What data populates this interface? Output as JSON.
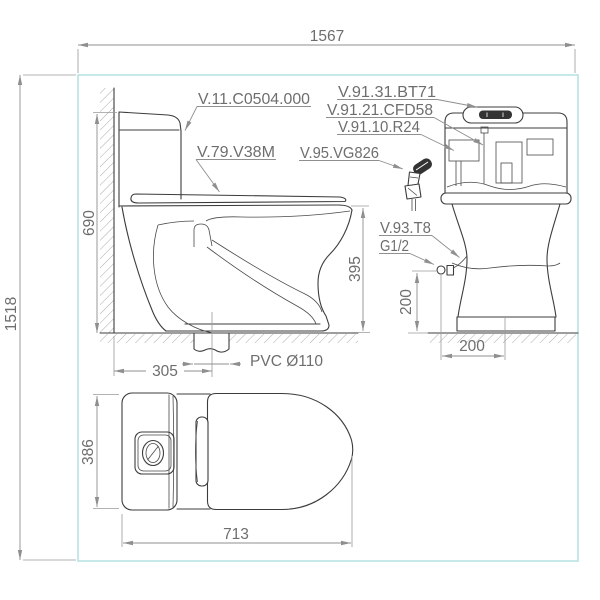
{
  "drawing": {
    "overall": {
      "width": "1567",
      "height": "1518"
    },
    "side_view": {
      "height": "690",
      "bowl_height": "395",
      "drain_offset": "305",
      "drain_pipe_label": "PVC Ø110"
    },
    "front_view": {
      "inlet_height": "200",
      "inlet_offset": "200"
    },
    "top_view": {
      "width": "386",
      "depth": "713"
    }
  },
  "part_labels": {
    "toilet_model": "V.11.C0504.000",
    "seat": "V.79.V38M",
    "flush_button": "V.91.31.BT71",
    "flush_valve": "V.91.21.CFD58",
    "inlet_valve": "V.91.10.R24",
    "sprayer": "V.95.VG826",
    "angle_valve": "V.93.T8",
    "thread": "G1/2"
  },
  "colors": {
    "drawing_line": "#3c3c3c",
    "annotation": "#8f8f8f",
    "text": "#6e6e6e",
    "border": "#b8e2e2",
    "background": "#ffffff"
  }
}
